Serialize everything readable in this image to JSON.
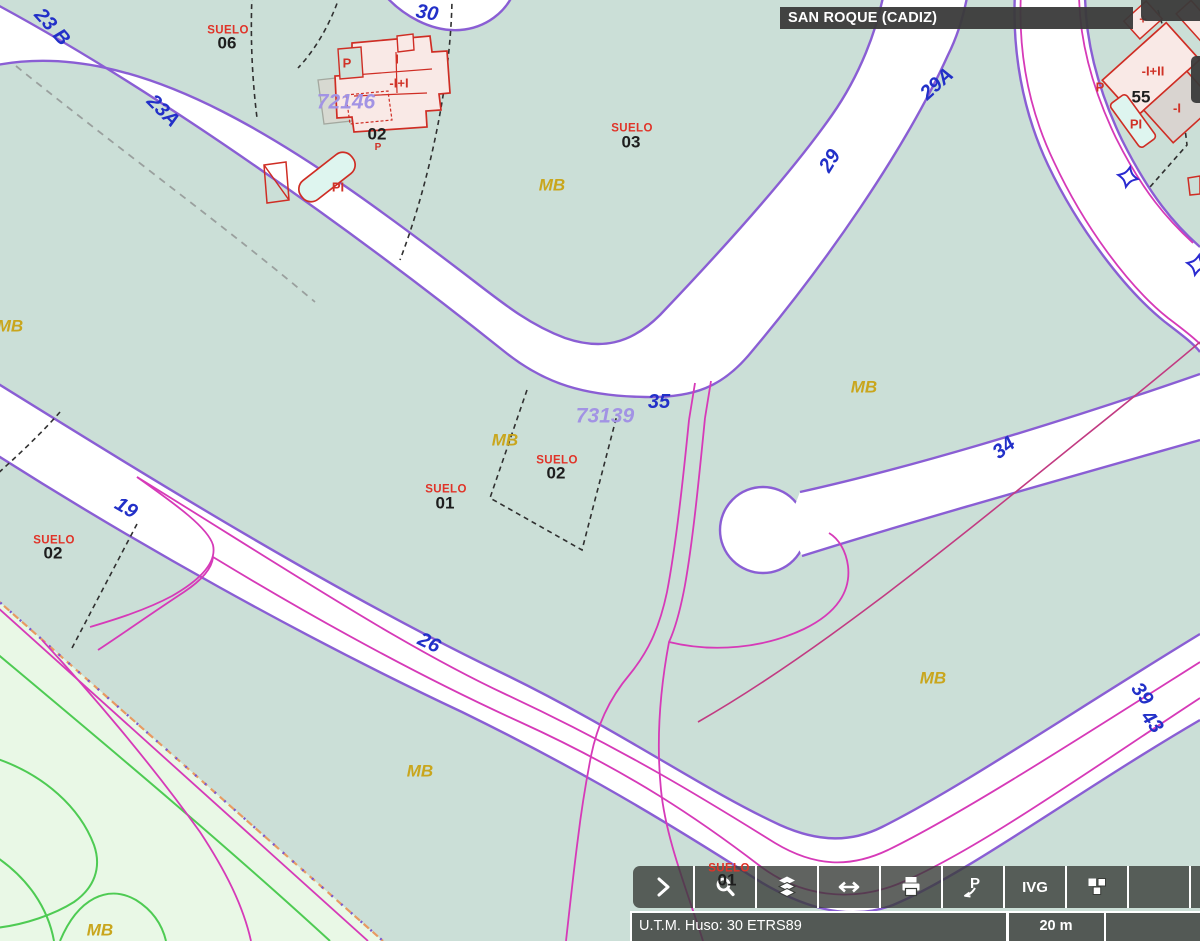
{
  "header": {
    "title": "SAN ROQUE (CADIZ)"
  },
  "toolbar": {
    "ivg_label": "IVG",
    "buttons": [
      {
        "name": "expand",
        "icon": "chevron-right-icon"
      },
      {
        "name": "zoom",
        "icon": "magnifier-icon"
      },
      {
        "name": "layers",
        "icon": "layers-icon"
      },
      {
        "name": "measure",
        "icon": "double-arrow-icon"
      },
      {
        "name": "print",
        "icon": "printer-icon"
      },
      {
        "name": "reference-point",
        "icon": "p-arrow-icon"
      },
      {
        "name": "ivg",
        "icon": "text-label"
      },
      {
        "name": "3d-view",
        "icon": "cubes-icon"
      }
    ]
  },
  "statusbar": {
    "crs": "U.T.M. Huso: 30 ETRS89",
    "scale": "20 m"
  },
  "map": {
    "colors": {
      "background": "#cbdfd7",
      "zone_fill": "#e9f8e6",
      "road_fill": "#ffffff",
      "road_edge_purple": "#8a5ed4",
      "magenta_line": "#d63ab8",
      "crimson_line": "#c23b82",
      "contour_green": "#4ecb53",
      "parcel_dash_black": "#303030",
      "building_fill": "#f9e9e6",
      "building_stroke": "#cf2d24",
      "pool_fill": "#def5ef",
      "road_number_blue": "#2230c8",
      "parcel_number_purple": "#a293e4",
      "suelo_red": "#e03328",
      "mb_yellow": "#c9a61d"
    },
    "labels": [
      {
        "name": "road-number-23b",
        "text": "23 B",
        "x": 52,
        "y": 27,
        "r": 48,
        "c": "road"
      },
      {
        "name": "road-number-23a",
        "text": "23A",
        "x": 163,
        "y": 111,
        "r": 45,
        "c": "road"
      },
      {
        "name": "road-number-30",
        "text": "30",
        "x": 427,
        "y": 13,
        "r": 10,
        "c": "road"
      },
      {
        "name": "road-number-29a",
        "text": "29A",
        "x": 937,
        "y": 84,
        "r": -42,
        "c": "road"
      },
      {
        "name": "road-number-29",
        "text": "29",
        "x": 830,
        "y": 161,
        "r": -58,
        "c": "road"
      },
      {
        "name": "road-number-35",
        "text": "35",
        "x": 659,
        "y": 402,
        "r": 0,
        "c": "road"
      },
      {
        "name": "road-number-34",
        "text": "34",
        "x": 1004,
        "y": 448,
        "r": -38,
        "c": "road"
      },
      {
        "name": "road-number-19",
        "text": "19",
        "x": 126,
        "y": 508,
        "r": 30,
        "c": "road"
      },
      {
        "name": "road-number-26",
        "text": "26",
        "x": 429,
        "y": 643,
        "r": 26,
        "c": "road"
      },
      {
        "name": "road-number-39",
        "text": "39",
        "x": 1142,
        "y": 694,
        "r": 52,
        "c": "road"
      },
      {
        "name": "road-number-43",
        "text": "43",
        "x": 1152,
        "y": 722,
        "r": 52,
        "c": "road"
      },
      {
        "name": "parcel-number-72146",
        "text": "72146",
        "x": 346,
        "y": 102,
        "r": 0,
        "c": "parcel"
      },
      {
        "name": "parcel-number-73139",
        "text": "73139",
        "x": 605,
        "y": 416,
        "r": 0,
        "c": "parcel"
      },
      {
        "name": "suelo-label-06",
        "text": "SUELO",
        "x": 228,
        "y": 31,
        "r": 0,
        "c": "suelo"
      },
      {
        "name": "parcel-06",
        "text": "06",
        "x": 227,
        "y": 43,
        "r": 0,
        "c": "pnum"
      },
      {
        "name": "suelo-label-03",
        "text": "SUELO",
        "x": 632,
        "y": 129,
        "r": 0,
        "c": "suelo"
      },
      {
        "name": "parcel-03",
        "text": "03",
        "x": 631,
        "y": 142,
        "r": 0,
        "c": "pnum"
      },
      {
        "name": "suelo-label-02c",
        "text": "SUELO",
        "x": 557,
        "y": 461,
        "r": 0,
        "c": "suelo"
      },
      {
        "name": "parcel-02c",
        "text": "02",
        "x": 556,
        "y": 473,
        "r": 0,
        "c": "pnum"
      },
      {
        "name": "suelo-label-01c",
        "text": "SUELO",
        "x": 446,
        "y": 490,
        "r": 0,
        "c": "suelo"
      },
      {
        "name": "parcel-01c",
        "text": "01",
        "x": 445,
        "y": 503,
        "r": 0,
        "c": "pnum"
      },
      {
        "name": "suelo-label-02l",
        "text": "SUELO",
        "x": 54,
        "y": 541,
        "r": 0,
        "c": "suelo"
      },
      {
        "name": "parcel-02l",
        "text": "02",
        "x": 53,
        "y": 553,
        "r": 0,
        "c": "pnum"
      },
      {
        "name": "suelo-label-01b",
        "text": "SUELO",
        "x": 729,
        "y": 869,
        "r": 0,
        "c": "suelo"
      },
      {
        "name": "parcel-01b",
        "text": "01",
        "x": 727,
        "y": 880,
        "r": 0,
        "c": "pnum"
      },
      {
        "name": "parcel-55",
        "text": "55",
        "x": 1141,
        "y": 97,
        "r": 0,
        "c": "pnum"
      },
      {
        "name": "parcel-02-building",
        "text": "02",
        "x": 377,
        "y": 134,
        "r": 0,
        "c": "pnum"
      },
      {
        "name": "building-label-p1",
        "text": "P",
        "x": 347,
        "y": 63,
        "r": 0,
        "c": "bred"
      },
      {
        "name": "building-label-i",
        "text": "I",
        "x": 397,
        "y": 59,
        "r": 0,
        "c": "bred"
      },
      {
        "name": "building-label-floors1",
        "text": "-I+I",
        "x": 399,
        "y": 83,
        "r": 0,
        "c": "bred"
      },
      {
        "name": "building-label-pool1",
        "text": "PI",
        "x": 338,
        "y": 187,
        "r": 0,
        "c": "bred"
      },
      {
        "name": "building-label-p-small",
        "text": "P",
        "x": 378,
        "y": 148,
        "r": 0,
        "c": "bred-sm"
      },
      {
        "name": "building-label-floors2",
        "text": "-I+II",
        "x": 1153,
        "y": 71,
        "r": 0,
        "c": "bred"
      },
      {
        "name": "building-label-floors3",
        "text": "-I",
        "x": 1177,
        "y": 108,
        "r": 0,
        "c": "bred"
      },
      {
        "name": "building-label-pool2",
        "text": "PI",
        "x": 1136,
        "y": 124,
        "r": 0,
        "c": "bred"
      },
      {
        "name": "building-label-p2",
        "text": "P",
        "x": 1100,
        "y": 87,
        "r": 0,
        "c": "bred"
      },
      {
        "name": "building-label-plus",
        "text": "+",
        "x": 1143,
        "y": 19,
        "r": 0,
        "c": "bred"
      },
      {
        "name": "zone-label-mb-1",
        "text": "MB",
        "x": 10,
        "y": 326,
        "r": 0,
        "c": "mb"
      },
      {
        "name": "zone-label-mb-2",
        "text": "MB",
        "x": 552,
        "y": 185,
        "r": 0,
        "c": "mb"
      },
      {
        "name": "zone-label-mb-3",
        "text": "MB",
        "x": 505,
        "y": 440,
        "r": 0,
        "c": "mb"
      },
      {
        "name": "zone-label-mb-4",
        "text": "MB",
        "x": 864,
        "y": 387,
        "r": 0,
        "c": "mb"
      },
      {
        "name": "zone-label-mb-5",
        "text": "MB",
        "x": 420,
        "y": 771,
        "r": 0,
        "c": "mb"
      },
      {
        "name": "zone-label-mb-6",
        "text": "MB",
        "x": 933,
        "y": 678,
        "r": 0,
        "c": "mb"
      },
      {
        "name": "zone-label-mb-7",
        "text": "MB",
        "x": 100,
        "y": 930,
        "r": 0,
        "c": "mb"
      }
    ]
  }
}
